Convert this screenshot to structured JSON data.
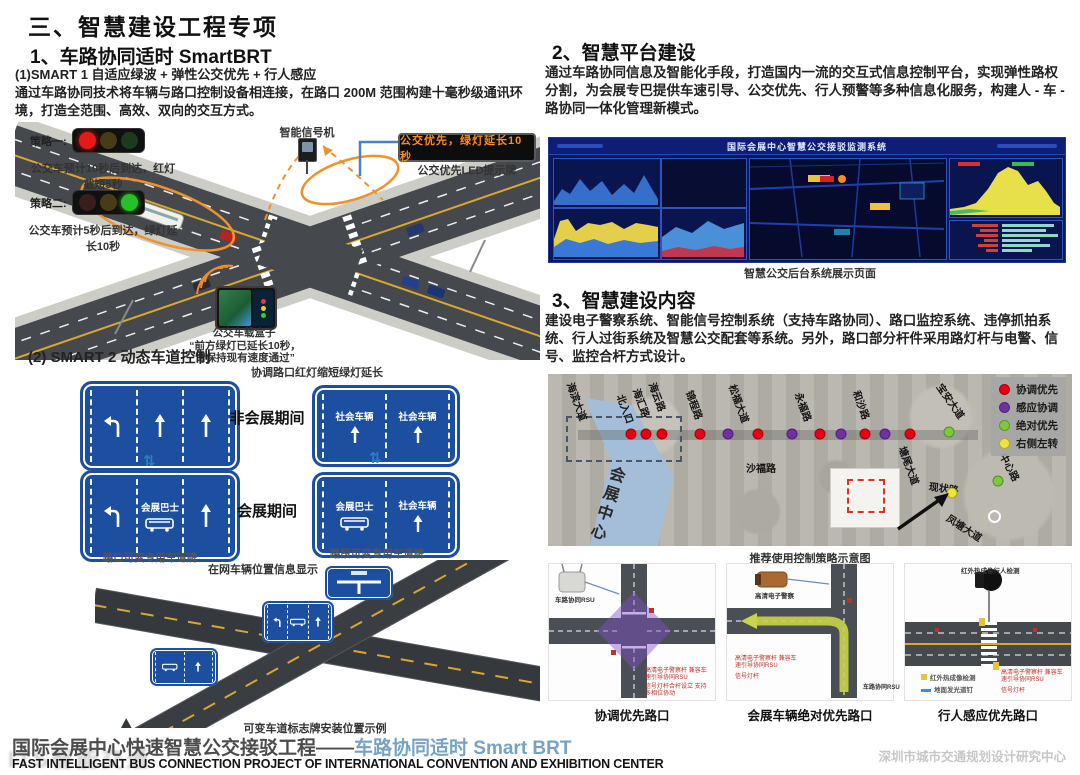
{
  "page": {
    "title": "三、智慧建设工程专项"
  },
  "colors": {
    "sign_blue": "#1d4fa0",
    "led_orange": "#ff8a1e",
    "footer_blue": "#76a3c4",
    "dot_red": "#e60012",
    "dot_purple": "#7030a0",
    "dot_green": "#7fc83c",
    "dot_yellow": "#f0e43c"
  },
  "section1": {
    "heading": "1、车路协同适时 SmartBRT",
    "sub1": "(1)SMART 1 自适应绿波 + 弹性公交优先 + 行人感应",
    "para": "通过车路协同技术将车辆与路口控制设备相连接，在路口 200M 范围构建十毫秒级通讯环境，打造全范围、高效、双向的交互方式。",
    "diagram": {
      "strategy1_label": "策略一:",
      "strategy1_text": "公交车预计10秒后到达，红灯截短5秒",
      "strategy2_label": "策略二:",
      "strategy2_text": "公交车预计5秒后到达，绿灯延长10秒",
      "signal_machine": "智能信号机",
      "led_sign_text": "公交优先，绿灯延长10秒",
      "led_sign_label": "公交优先LED提示牌",
      "obu_label": "公交车载盒子",
      "obu_quote1": "“前方绿灯已延长10秒，",
      "obu_quote2": "请保持现有速度通过”",
      "coordination_note": "协调路口红灯缩短绿灯延长"
    },
    "sub2": "(2) SMART 2 动态车道控制",
    "signs": {
      "non_expo": "非会展期间",
      "expo": "会展期间",
      "social_vehicle": "社会车辆",
      "expo_bus": "会展巴士",
      "cap_left": "路口可变专用车道牌",
      "cap_right": "路段可变专用车道牌",
      "online_info": "在网车辆位置信息显示"
    },
    "xroad_caption": "可变车道标志牌安装位置示例"
  },
  "section2": {
    "heading": "2、智慧平台建设",
    "para": "通过车路协同信息及智能化手段，打造国内一流的交互式信息控制平台，实现弹性路权分割，为会展专巴提供车速引导、公交优先、行人预警等多种信息化服务，构建人 - 车 - 路协同一体化管理新模式。",
    "dashboard_title": "国际会展中心智慧公交接驳监测系统",
    "dashboard_caption": "智慧公交后台系统展示页面"
  },
  "section3": {
    "heading": "3、智慧建设内容",
    "para": "建设电子警察系统、智能信号控制系统（支持车路协同）、路口监控系统、违停抓拍系统、行人过街系统及智慧公交配套等系统。另外，路口部分杆件采用路灯杆与电警、信号、监控合杆方式设计。",
    "map": {
      "legend": [
        {
          "color": "#e60012",
          "label": "协调优先"
        },
        {
          "color": "#7030a0",
          "label": "感应协调"
        },
        {
          "color": "#7fc83c",
          "label": "绝对优先"
        },
        {
          "color": "#f0e43c",
          "label": "右侧左转"
        }
      ],
      "dots": [
        {
          "x": 83,
          "y": 60,
          "color": "#e60012"
        },
        {
          "x": 98,
          "y": 60,
          "color": "#e60012"
        },
        {
          "x": 114,
          "y": 60,
          "color": "#e60012"
        },
        {
          "x": 152,
          "y": 60,
          "color": "#e60012"
        },
        {
          "x": 180,
          "y": 60,
          "color": "#7030a0"
        },
        {
          "x": 210,
          "y": 60,
          "color": "#e60012"
        },
        {
          "x": 244,
          "y": 60,
          "color": "#7030a0"
        },
        {
          "x": 272,
          "y": 60,
          "color": "#e60012"
        },
        {
          "x": 293,
          "y": 60,
          "color": "#7030a0"
        },
        {
          "x": 317,
          "y": 60,
          "color": "#e60012"
        },
        {
          "x": 337,
          "y": 60,
          "color": "#7030a0"
        },
        {
          "x": 362,
          "y": 60,
          "color": "#e60012"
        },
        {
          "x": 401,
          "y": 58,
          "color": "#7fc83c"
        },
        {
          "x": 404,
          "y": 119,
          "color": "#f0e43c"
        },
        {
          "x": 450,
          "y": 107,
          "color": "#7fc83c"
        }
      ],
      "roads": [
        "海滨大道",
        "北入口",
        "海汇路",
        "海云路",
        "锦程路",
        "松福大道",
        "永福路",
        "和沙路",
        "宝安大道",
        "塘尾大道",
        "沙福路",
        "现状路",
        "凤塘大道",
        "中心路",
        "会展中心"
      ],
      "caption": "推荐使用控制策略示意图"
    },
    "diagrams": [
      {
        "caption": "协调优先路口",
        "device_label": "车路协同RSU",
        "note1": "高清电子警察杆 兼容车速引导协同RSU",
        "note2": "信号灯杆合杆设立 支持多相位协动"
      },
      {
        "caption": "会展车辆绝对优先路口",
        "device_label": "高清电子警察",
        "note1": "高清电子警察杆 兼容车速引导协同RSU",
        "note2": "信号灯杆",
        "rsu_label": "车路协同RSU"
      },
      {
        "caption": "行人感应优先路口",
        "device_label": "红外热成像行人检测",
        "note1": "红外热成像检测",
        "note2": "地面发光道钉",
        "note3": "高清电子警察杆 兼容车速引导协同RSU",
        "note4": "信号灯杆"
      }
    ]
  },
  "footer": {
    "title_zh_gray": "国际会展中心快速智慧公交接驳工程——",
    "title_zh_blue": "车路协同适时 Smart BRT",
    "title_en": "FAST INTELLIGENT BUS CONNECTION PROJECT OF INTERNATIONAL CONVENTION AND EXHIBITION CENTER",
    "org": "深圳市城市交通规划设计研究中心",
    "watermark": "ITS智能交通"
  }
}
